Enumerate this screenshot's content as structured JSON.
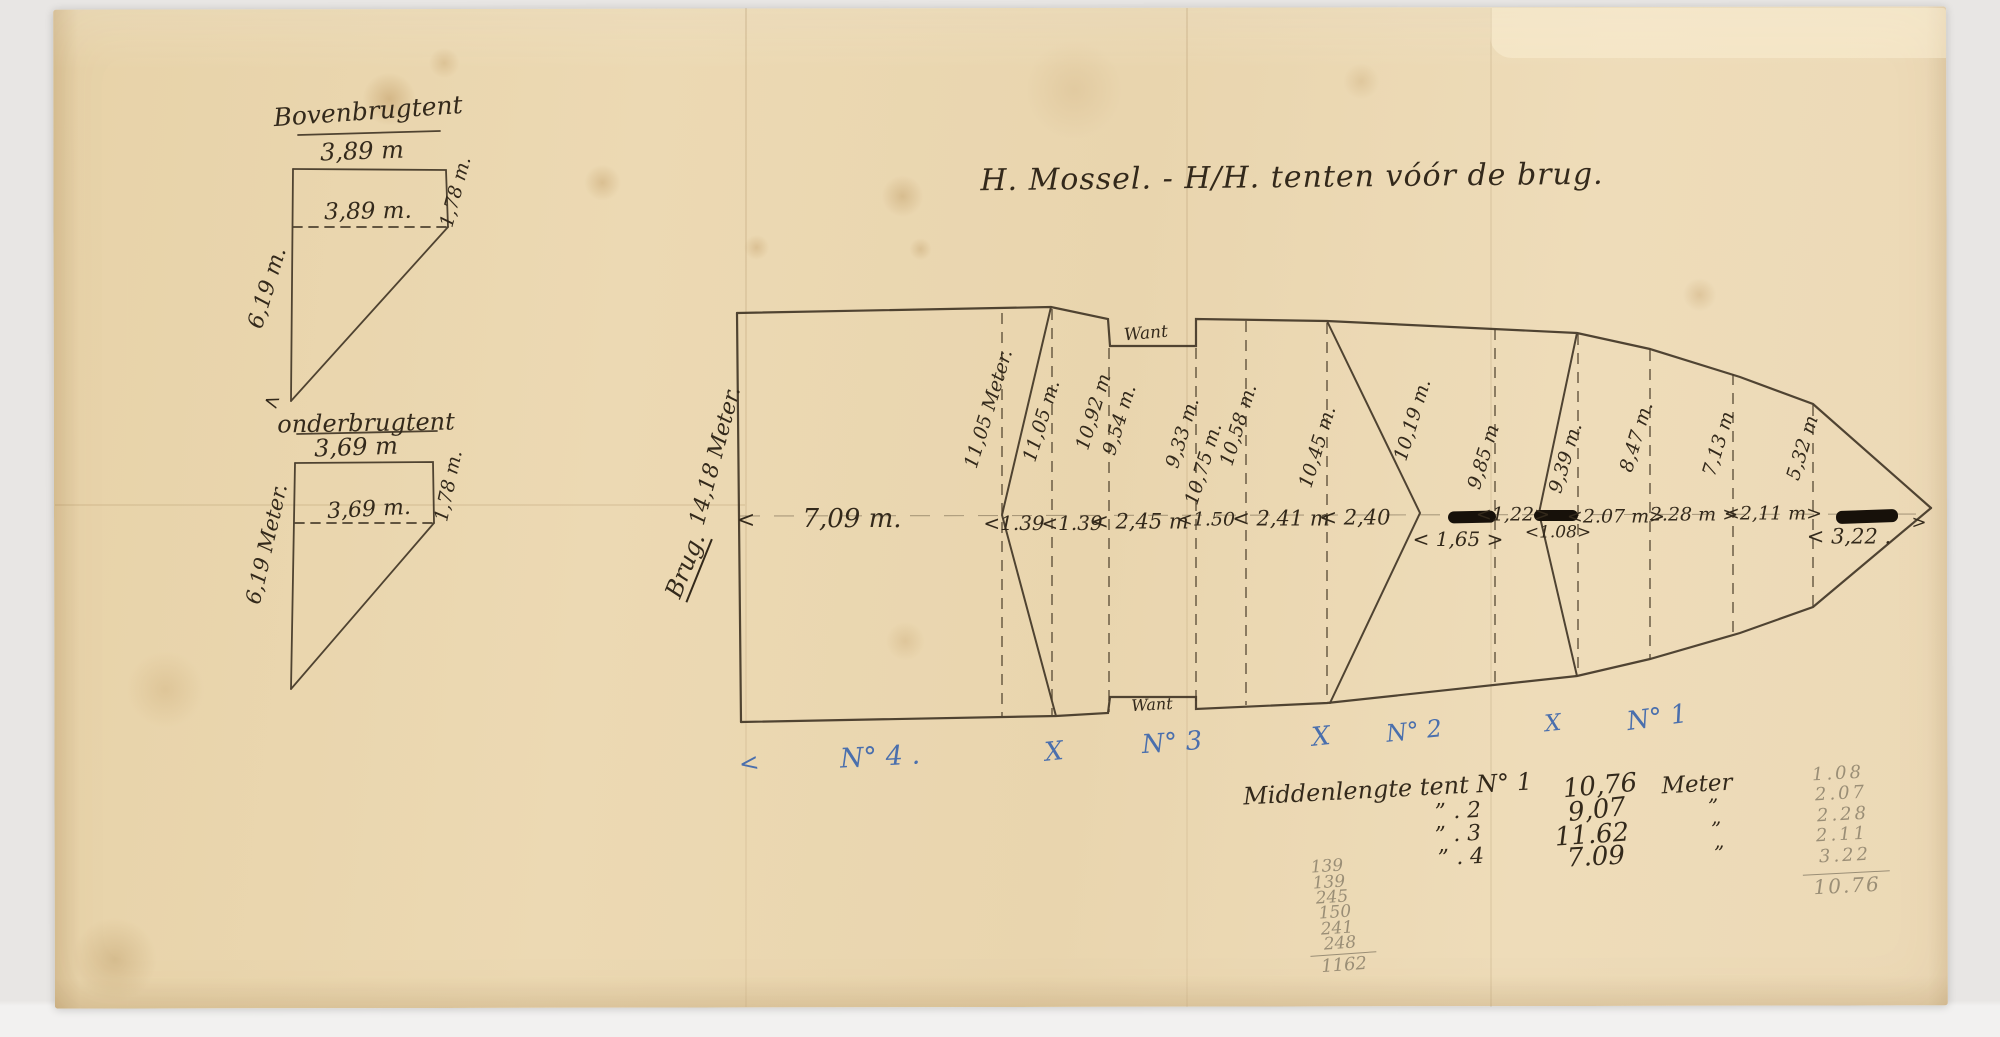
{
  "colors": {
    "background": "#e8e6e4",
    "paper": "#ead7b1",
    "ink": "#33291b",
    "blue_pencil": "#4a6fad",
    "graphite_pencil": "#9a8e76"
  },
  "title": "H. Mossel. -   H/H. tenten vóór de brug.",
  "upper_tent": {
    "name": "Bovenbrugtent",
    "top_width": "3,89 m",
    "inner_width": "3,89 m.",
    "right_side": "1,78 m.",
    "left_side": "6,19 m.",
    "tip_arrow": "<"
  },
  "lower_tent": {
    "name": "onderbrugtent",
    "top_width": "3,69 m",
    "inner_width": "3,69 m.",
    "right_side": "1,78 m.",
    "left_side": "6,19 Meter."
  },
  "deck": {
    "left_label": "Brug.",
    "left_length": "14,18 Meter.",
    "want_top": "Want",
    "want_bottom": "Want",
    "left_arrow": "<",
    "bow_arrow": ">",
    "widths": [
      "11,05 Meter.",
      "11,05 m.",
      "10,92 m",
      "9,54 m.",
      "9,33 m.",
      "10,75 m.",
      "10,58 m.",
      "10,45 m.",
      "10,19 m.",
      "9,85 m",
      "9,39 m.",
      "8,47 m.",
      "7,13 m",
      "5,32 m"
    ],
    "lengths": [
      "7,09 m.",
      "<1.39",
      "<1.39",
      "< 2,45 m",
      "<1.50",
      "< 2,41 m",
      "< 2,40",
      "<1,22>",
      "< 1,65 >",
      "<1.08>",
      "<2.07 m>",
      "2.28 m >",
      "<2,11 m>",
      "< 3,22 ."
    ]
  },
  "sections": [
    "<",
    "N° 4 .",
    "X",
    "N° 3",
    "X",
    "N° 2",
    "X",
    "N° 1"
  ],
  "table": {
    "rows": [
      {
        "label": "Middenlengte tent N° 1",
        "value": "10,76",
        "unit": "Meter"
      },
      {
        "label": "”   .  2",
        "value": "9,07",
        "unit": "”"
      },
      {
        "label": "”   .  3",
        "value": "11.62",
        "unit": "”"
      },
      {
        "label": "”   .  4",
        "value": "7.09",
        "unit": "”"
      }
    ]
  },
  "pencil_left": {
    "values": [
      "139",
      "139",
      "245",
      "150",
      "241",
      "248"
    ],
    "total": "1162"
  },
  "pencil_right": {
    "values": [
      "1.08",
      "2.07",
      "2.28",
      "2.11",
      "3.22"
    ],
    "total": "10.76"
  }
}
